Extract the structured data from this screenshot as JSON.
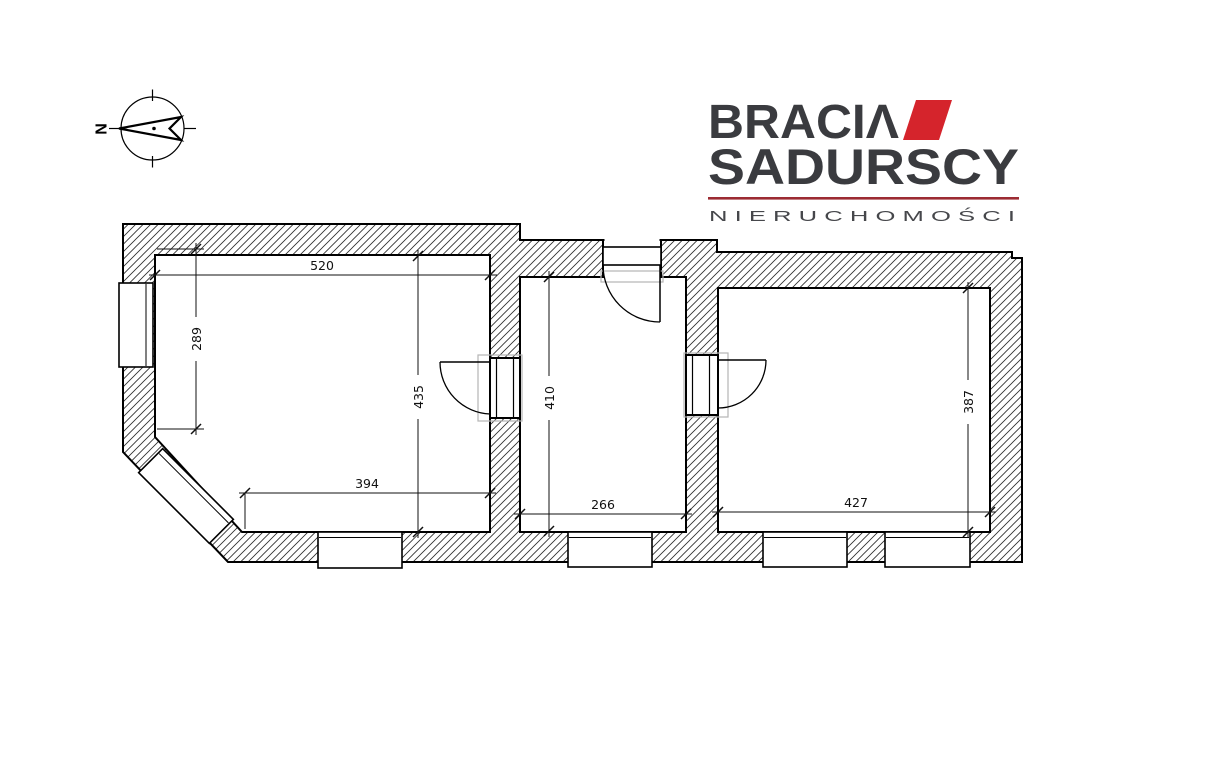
{
  "compass": {
    "north_label": "N"
  },
  "logo": {
    "brand_line1": "BRACIΛ",
    "brand_line2": "SADURSCY",
    "tagline": "N I E R U C H O M O Ś C I",
    "colors": {
      "text_dark": "#3a3b3f",
      "accent_red": "#d5242c",
      "underline_red": "#9c2b33",
      "tagline_gray": "#46474b"
    }
  },
  "floor_plan": {
    "dimensions": {
      "room_left": {
        "top_width": "520",
        "left_height": "289",
        "full_height": "435",
        "bottom_width": "394"
      },
      "room_middle": {
        "height": "410",
        "bottom_width": "266"
      },
      "room_right": {
        "height": "387",
        "bottom_width": "427"
      }
    }
  }
}
